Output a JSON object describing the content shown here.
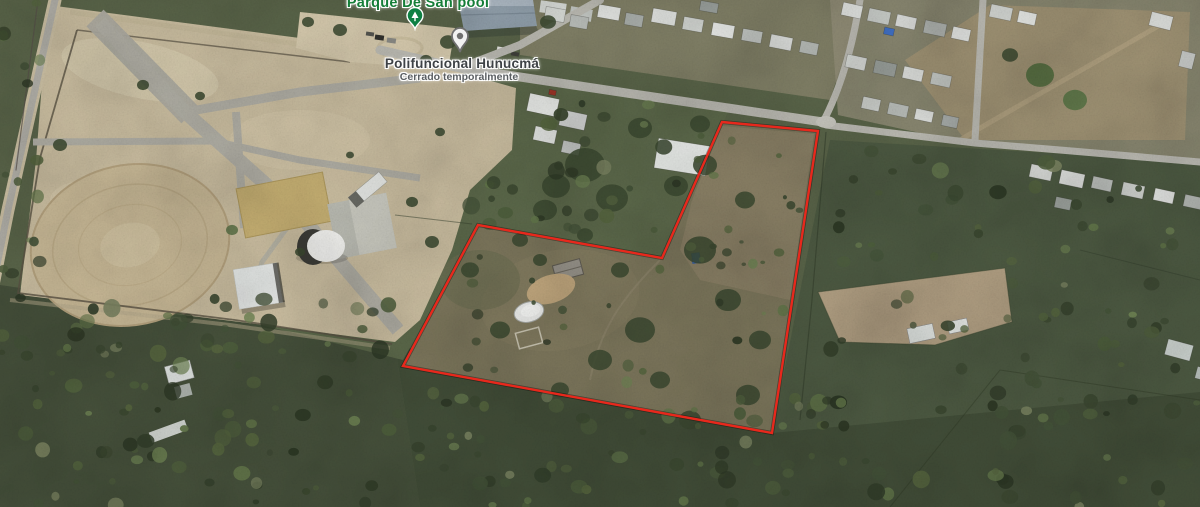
{
  "map": {
    "place_labels": {
      "park": {
        "text": "Parque De San pool",
        "color": "#157e38",
        "x": 418,
        "y": -5
      },
      "facility": {
        "text": "Polifuncional Hunucmá",
        "color": "#3e4246",
        "x": 462,
        "y": 56
      },
      "facility_status": {
        "text": "Cerrado temporalmente",
        "color": "#5a5e62",
        "x": 459,
        "y": 71
      }
    },
    "markers": {
      "park_marker": {
        "label": "park",
        "color": "#0e8043",
        "x": 405,
        "y": 7
      },
      "place_pin": {
        "label": "closed place",
        "color": "#6f6f6f",
        "x": 449,
        "y": 26
      }
    },
    "property_boundary": {
      "color": "#e8281c",
      "points": [
        [
          722,
          122
        ],
        [
          818,
          131
        ],
        [
          772,
          433
        ],
        [
          403,
          366
        ],
        [
          478,
          225
        ],
        [
          662,
          258
        ]
      ]
    }
  }
}
